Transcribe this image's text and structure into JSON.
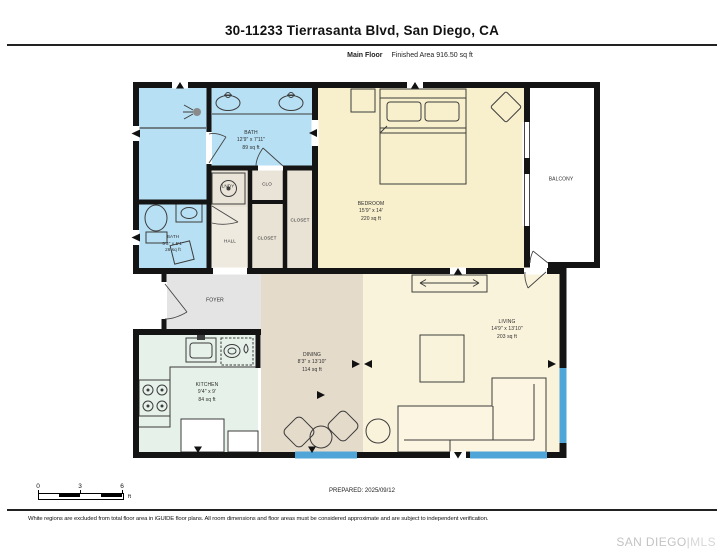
{
  "header": {
    "title": "30-11233 Tierrasanta Blvd, San Diego, CA",
    "floor_label": "Main Floor",
    "area_label": "Finished Area 916.50 sq ft"
  },
  "rooms": {
    "bath_main": {
      "name": "BATH",
      "dims": "12'9\" x 7'11\"",
      "area": "89 sq ft"
    },
    "bath_small": {
      "name": "BATH",
      "dims": "5'3\" x 5'1\"",
      "area": "26 sq ft"
    },
    "bedroom": {
      "name": "BEDROOM",
      "dims": "15'9\" x 14'",
      "area": "220 sq ft"
    },
    "balcony": {
      "name": "BALCONY"
    },
    "lndy": {
      "name": "LNDY"
    },
    "clo": {
      "name": "CLO"
    },
    "closet_right": {
      "name": "CLOSET"
    },
    "closet_left": {
      "name": "CLOSET"
    },
    "hall": {
      "name": "HALL"
    },
    "foyer": {
      "name": "FOYER"
    },
    "kitchen": {
      "name": "KITCHEN",
      "dims": "9'4\" x 9'",
      "area": "84 sq ft"
    },
    "dining": {
      "name": "DINING",
      "dims": "8'3\" x 13'10\"",
      "area": "114 sq ft"
    },
    "living": {
      "name": "LIVING",
      "dims": "14'9\" x 13'10\"",
      "area": "203 sq ft"
    }
  },
  "scale_bar": {
    "ticks": [
      "0",
      "3",
      "6"
    ],
    "unit": "ft"
  },
  "footer": {
    "prepared": "PREPARED: 2025/09/12",
    "disclaimer": "White regions are excluded from total floor area in iGUIDE floor plans. All room dimensions and floor areas must be considered approximate and are subject to independent verification.",
    "watermark_primary": "SAN DIEGO",
    "watermark_divider": "|",
    "watermark_secondary": "MLS"
  },
  "colors": {
    "wall": "#141414",
    "window": "#4fa5d8",
    "bath": "#b7e0f4",
    "bedroom": "#f8efcc",
    "living": "#faf3dc",
    "dining": "#e5dbcb",
    "kitchen": "#e6f1e9",
    "foyer": "#e4e4e4",
    "closet": "#e9e3d5"
  }
}
